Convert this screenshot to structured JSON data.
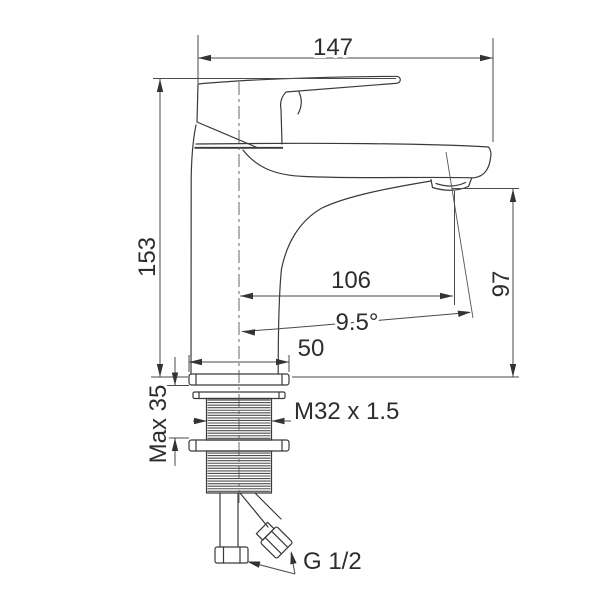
{
  "labels": {
    "overall_width": "147",
    "overall_height": "153",
    "spout_reach": "106",
    "outlet_height": "97",
    "outlet_angle": "9.5°",
    "base_width": "50",
    "max_mounting_thickness": "Max 35",
    "shank_thread": "M32 x 1.5",
    "inlet_connection": "G 1/2"
  }
}
